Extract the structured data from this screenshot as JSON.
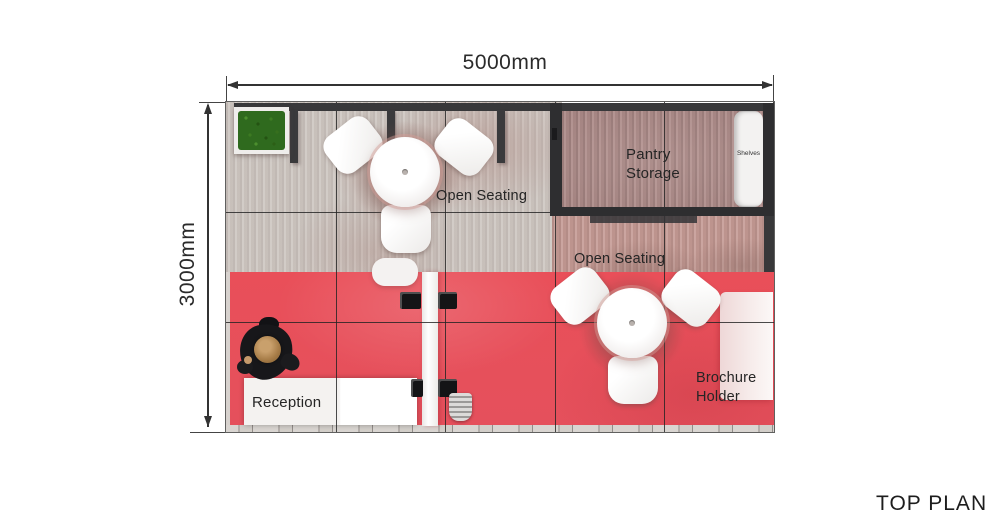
{
  "title": "TOP PLAN",
  "dimensions": {
    "width_label": "5000mm",
    "height_label": "3000mm"
  },
  "labels": {
    "open_seating_top": "Open Seating",
    "open_seating_bottom": "Open Seating",
    "pantry_line1": "Pantry",
    "pantry_line2": "Storage",
    "shelves": "Shelves",
    "reception": "Reception",
    "brochure_line1": "Brochure",
    "brochure_line2": "Holder"
  },
  "colors": {
    "floor_red": "#e7515c",
    "wood_light": "#cdc6c1",
    "wood_rose": "#c49a94",
    "pantry_floor": "#ab8a88",
    "wall_dark": "#38383a",
    "furniture_white": "#f6f4f2",
    "plant_green": "#2f6a1e",
    "dimension_line": "#333333",
    "text": "#2b2b2b"
  },
  "objects": [
    "plant-box",
    "round-table-with-3-chairs",
    "round-table-with-3-chairs",
    "pantry-storage-room",
    "shelves-unit",
    "reception-desk",
    "person",
    "partition-wall",
    "display-screens",
    "step-stool",
    "brochure-holder-panel"
  ]
}
